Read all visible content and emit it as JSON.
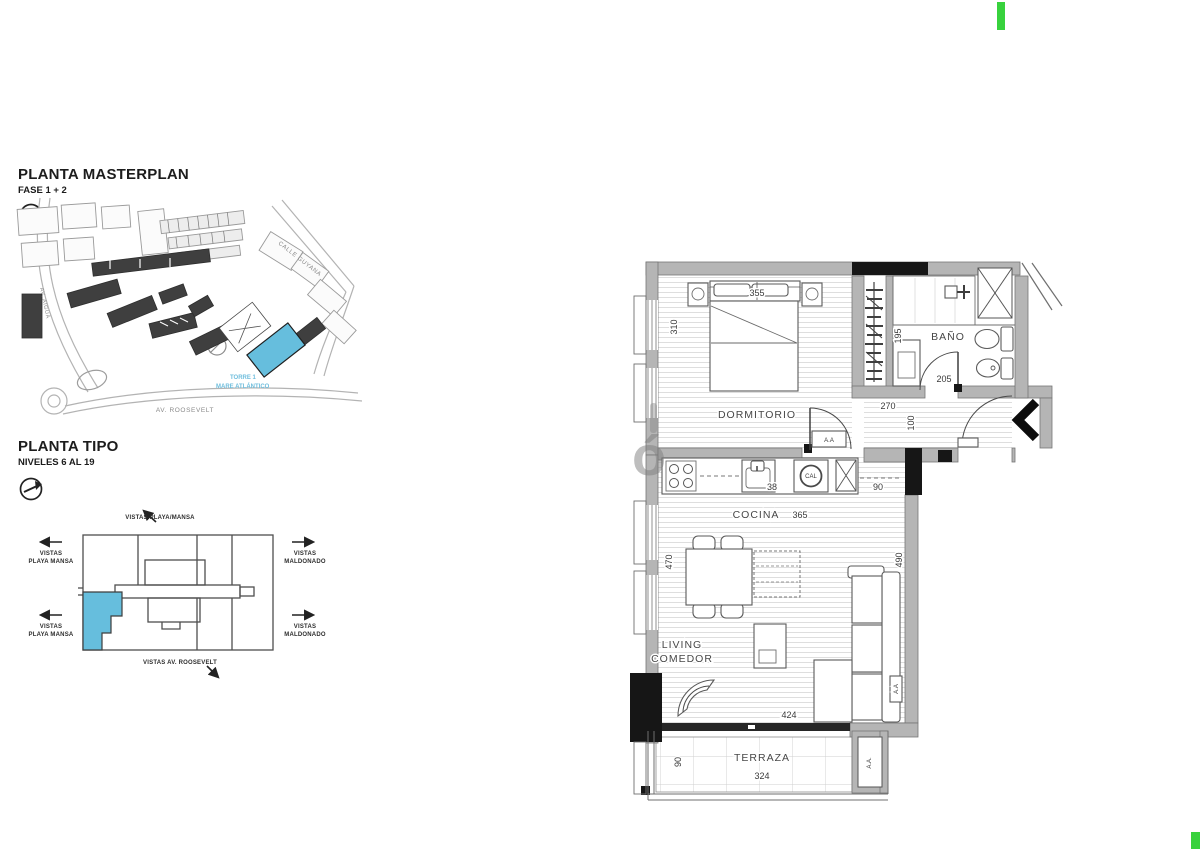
{
  "watermark": {
    "glyph": "ó"
  },
  "masterplan": {
    "title": "PLANTA MASTERPLAN",
    "phase": "FASE 1 + 2",
    "street_guyana": "CALLE GUYANA",
    "street_roosevelt": "AV. ROOSEVELT",
    "street_aigua": "AV. AIGUÁ",
    "tower_line1": "TORRE 1",
    "tower_line2": "MARE ATLÁNTICO",
    "highlight_color": "#66bedd"
  },
  "keyplan": {
    "title": "PLANTA TIPO",
    "levels": "NIVELES 6 AL 19",
    "view_top": "VISTAS PLAYA/MANSA",
    "view_left_line1": "VISTAS",
    "view_left_line2": "PLAYA MANSA",
    "view_right_line1": "VISTAS",
    "view_right_line2": "MALDONADO",
    "view_bottom": "VISTAS AV. ROOSEVELT",
    "highlight_color": "#66bedd"
  },
  "floorplan": {
    "rooms": {
      "bedroom": "DORMITORIO",
      "bathroom": "BAÑO",
      "kitchen": "COCINA",
      "living_line1": "LIVING",
      "living_line2": "COMEDOR",
      "terrace": "TERRAZA"
    },
    "dims": {
      "bedroom_width": "355",
      "bedroom_depth": "310",
      "closet": "195",
      "bathroom_width": "205",
      "hall_width": "270",
      "hall_depth": "100",
      "kitchen_length": "365",
      "kitchen_pass": "90",
      "sink": "38",
      "living_left": "470",
      "living_right": "490",
      "living_width": "424",
      "terrace_width": "324",
      "terrace_depth": "90"
    },
    "tags": {
      "ac_bedroom": "A.A",
      "ac_sofa": "A.A",
      "ac_terrace": "A.A.",
      "heater": "CAL"
    }
  },
  "accents": {
    "green": "#38d23d"
  }
}
